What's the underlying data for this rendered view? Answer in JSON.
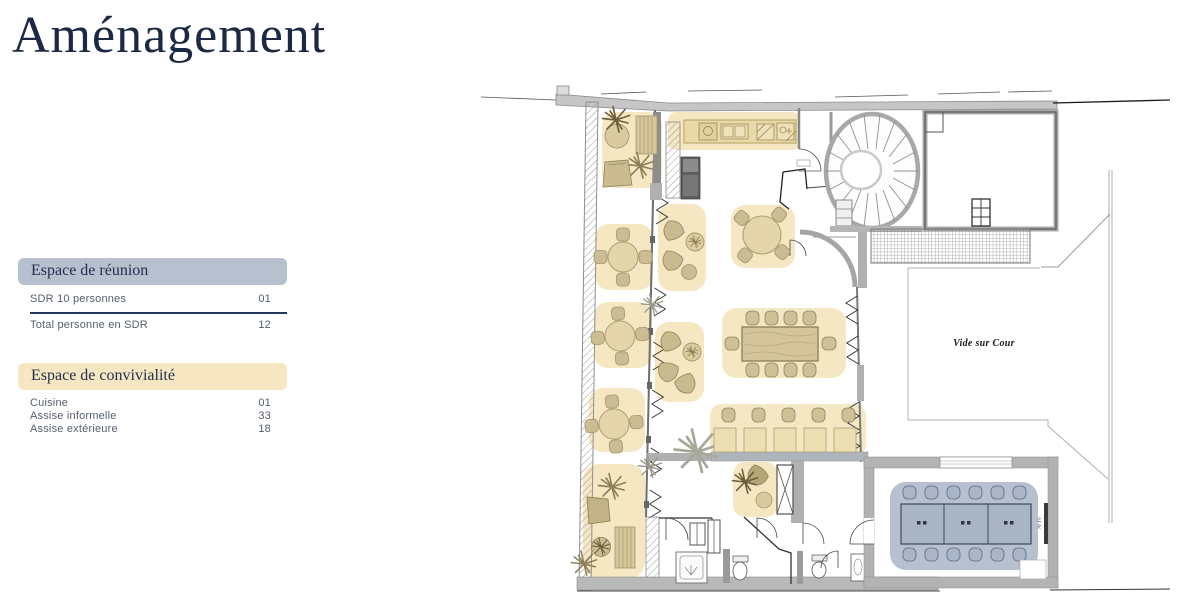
{
  "page": {
    "title": "Aménagement",
    "background": "#ffffff"
  },
  "panels": [
    {
      "header": "Espace de réunion",
      "header_bg": "#b7c0cf",
      "rows": [
        {
          "label": "SDR 10 personnes",
          "value": "01"
        },
        {
          "label": "Total personne en SDR",
          "value": "12"
        }
      ]
    },
    {
      "header": "Espace de convivialité",
      "header_bg": "#f6e7c2",
      "rows": [
        {
          "label": "Cuisine",
          "value": "01"
        },
        {
          "label": "Assise informelle",
          "value": "33"
        },
        {
          "label": "Assise extérieure",
          "value": "18"
        }
      ]
    }
  ],
  "floorplan": {
    "labels": {
      "courtyard": "Vide sur Cour",
      "tv": "70' TV"
    },
    "colors": {
      "highlight_beige": "#f5e7c2",
      "furniture_beige": "#cfc096",
      "highlight_blue": "#b6c0cf",
      "wall_gray": "#b8b8b8",
      "title_navy": "#1c2945"
    }
  }
}
